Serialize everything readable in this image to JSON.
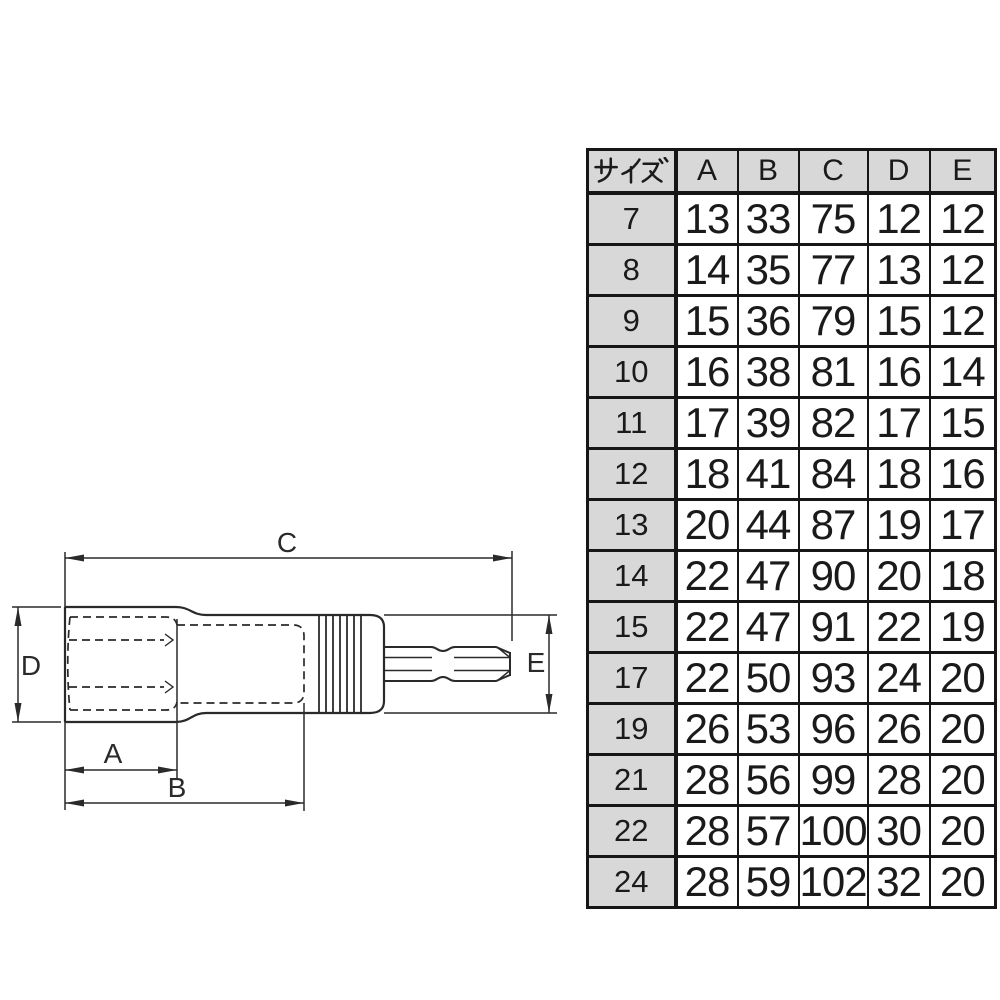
{
  "colors": {
    "line": "#2a2a2a",
    "table_border": "#161616",
    "header_bg": "#d8d8d8",
    "text": "#1a1a1a",
    "background": "#ffffff"
  },
  "diagram": {
    "description": "dimension drawing of hex socket with quick-change bit shank",
    "dimension_labels": {
      "a": "A",
      "b": "B",
      "c": "C",
      "d": "D",
      "e": "E"
    }
  },
  "table": {
    "size_header": "サイズ",
    "columns": [
      "A",
      "B",
      "C",
      "D",
      "E"
    ],
    "rows": [
      {
        "size": "7",
        "values": [
          "13",
          "33",
          "75",
          "12",
          "12"
        ]
      },
      {
        "size": "8",
        "values": [
          "14",
          "35",
          "77",
          "13",
          "12"
        ]
      },
      {
        "size": "9",
        "values": [
          "15",
          "36",
          "79",
          "15",
          "12"
        ]
      },
      {
        "size": "10",
        "values": [
          "16",
          "38",
          "81",
          "16",
          "14"
        ]
      },
      {
        "size": "11",
        "values": [
          "17",
          "39",
          "82",
          "17",
          "15"
        ]
      },
      {
        "size": "12",
        "values": [
          "18",
          "41",
          "84",
          "18",
          "16"
        ]
      },
      {
        "size": "13",
        "values": [
          "20",
          "44",
          "87",
          "19",
          "17"
        ]
      },
      {
        "size": "14",
        "values": [
          "22",
          "47",
          "90",
          "20",
          "18"
        ]
      },
      {
        "size": "15",
        "values": [
          "22",
          "47",
          "91",
          "22",
          "19"
        ]
      },
      {
        "size": "17",
        "values": [
          "22",
          "50",
          "93",
          "24",
          "20"
        ]
      },
      {
        "size": "19",
        "values": [
          "26",
          "53",
          "96",
          "26",
          "20"
        ]
      },
      {
        "size": "21",
        "values": [
          "28",
          "56",
          "99",
          "28",
          "20"
        ]
      },
      {
        "size": "22",
        "values": [
          "28",
          "57",
          "100",
          "30",
          "20"
        ]
      },
      {
        "size": "24",
        "values": [
          "28",
          "59",
          "102",
          "32",
          "20"
        ]
      }
    ]
  }
}
